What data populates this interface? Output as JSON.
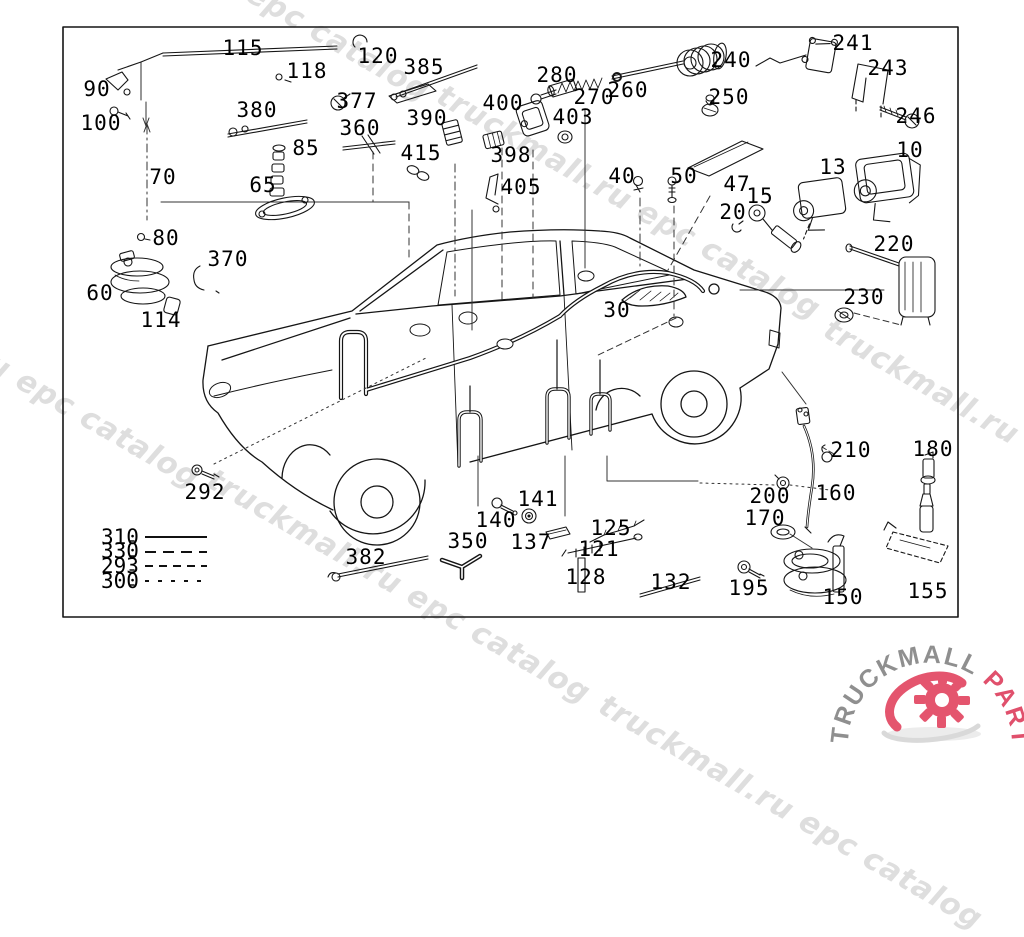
{
  "frame": {
    "border_color": "#000000",
    "background": "#ffffff"
  },
  "watermark": {
    "text": "truckmall.ru epc catalog",
    "color": "#dedede",
    "angle_deg": 30,
    "instances": [
      {
        "x": 448,
        "y": 78
      },
      {
        "x": 57,
        "y": -140
      },
      {
        "x": -173,
        "y": 247
      },
      {
        "x": 218,
        "y": 462
      },
      {
        "x": 610,
        "y": 688
      },
      {
        "x": 835,
        "y": 312
      }
    ]
  },
  "callouts": [
    {
      "id": "115",
      "x": 243,
      "y": 48
    },
    {
      "id": "120",
      "x": 378,
      "y": 56
    },
    {
      "id": "118",
      "x": 307,
      "y": 71
    },
    {
      "id": "90",
      "x": 97,
      "y": 89
    },
    {
      "id": "100",
      "x": 101,
      "y": 123
    },
    {
      "id": "377",
      "x": 357,
      "y": 101
    },
    {
      "id": "380",
      "x": 257,
      "y": 110
    },
    {
      "id": "385",
      "x": 424,
      "y": 67
    },
    {
      "id": "390",
      "x": 427,
      "y": 118
    },
    {
      "id": "360",
      "x": 360,
      "y": 128
    },
    {
      "id": "85",
      "x": 306,
      "y": 148
    },
    {
      "id": "70",
      "x": 163,
      "y": 177
    },
    {
      "id": "65",
      "x": 263,
      "y": 185
    },
    {
      "id": "415",
      "x": 421,
      "y": 153
    },
    {
      "id": "400",
      "x": 503,
      "y": 103
    },
    {
      "id": "398",
      "x": 511,
      "y": 155
    },
    {
      "id": "405",
      "x": 521,
      "y": 187
    },
    {
      "id": "403",
      "x": 573,
      "y": 117
    },
    {
      "id": "280",
      "x": 557,
      "y": 75
    },
    {
      "id": "270",
      "x": 594,
      "y": 97
    },
    {
      "id": "260",
      "x": 628,
      "y": 90
    },
    {
      "id": "240",
      "x": 731,
      "y": 60
    },
    {
      "id": "250",
      "x": 729,
      "y": 97
    },
    {
      "id": "241",
      "x": 853,
      "y": 43
    },
    {
      "id": "243",
      "x": 888,
      "y": 68
    },
    {
      "id": "246",
      "x": 916,
      "y": 116
    },
    {
      "id": "10",
      "x": 910,
      "y": 150
    },
    {
      "id": "13",
      "x": 833,
      "y": 167
    },
    {
      "id": "47",
      "x": 737,
      "y": 184
    },
    {
      "id": "15",
      "x": 760,
      "y": 196
    },
    {
      "id": "20",
      "x": 733,
      "y": 212
    },
    {
      "id": "40",
      "x": 622,
      "y": 176
    },
    {
      "id": "50",
      "x": 684,
      "y": 176
    },
    {
      "id": "80",
      "x": 166,
      "y": 238
    },
    {
      "id": "370",
      "x": 228,
      "y": 259
    },
    {
      "id": "60",
      "x": 100,
      "y": 293
    },
    {
      "id": "114",
      "x": 161,
      "y": 320
    },
    {
      "id": "30",
      "x": 617,
      "y": 310
    },
    {
      "id": "220",
      "x": 894,
      "y": 244
    },
    {
      "id": "230",
      "x": 864,
      "y": 297
    },
    {
      "id": "292",
      "x": 205,
      "y": 492
    },
    {
      "id": "382",
      "x": 366,
      "y": 557
    },
    {
      "id": "350",
      "x": 468,
      "y": 541
    },
    {
      "id": "140",
      "x": 496,
      "y": 520
    },
    {
      "id": "141",
      "x": 538,
      "y": 499
    },
    {
      "id": "137",
      "x": 531,
      "y": 542
    },
    {
      "id": "121",
      "x": 599,
      "y": 549
    },
    {
      "id": "125",
      "x": 611,
      "y": 528
    },
    {
      "id": "128",
      "x": 586,
      "y": 577
    },
    {
      "id": "132",
      "x": 671,
      "y": 582
    },
    {
      "id": "200",
      "x": 770,
      "y": 496
    },
    {
      "id": "160",
      "x": 836,
      "y": 493
    },
    {
      "id": "170",
      "x": 765,
      "y": 518
    },
    {
      "id": "210",
      "x": 851,
      "y": 450
    },
    {
      "id": "180",
      "x": 933,
      "y": 449
    },
    {
      "id": "195",
      "x": 749,
      "y": 588
    },
    {
      "id": "150",
      "x": 843,
      "y": 597
    },
    {
      "id": "155",
      "x": 928,
      "y": 591
    }
  ],
  "legend": {
    "items": [
      {
        "label": "310",
        "line_style": "solid"
      },
      {
        "label": "330",
        "line_style": "dash-long"
      },
      {
        "label": "293",
        "line_style": "dash-med"
      },
      {
        "label": "300",
        "line_style": "dash-short"
      }
    ]
  },
  "logo": {
    "brand": "TRUCKMALL",
    "accent": "PARTS",
    "brand_color": "#8f8f8f",
    "accent_color": "#e0506c",
    "gear_color": "#e4556e",
    "swoosh_color": "#e4556e",
    "shadow_color": "#ececec"
  }
}
